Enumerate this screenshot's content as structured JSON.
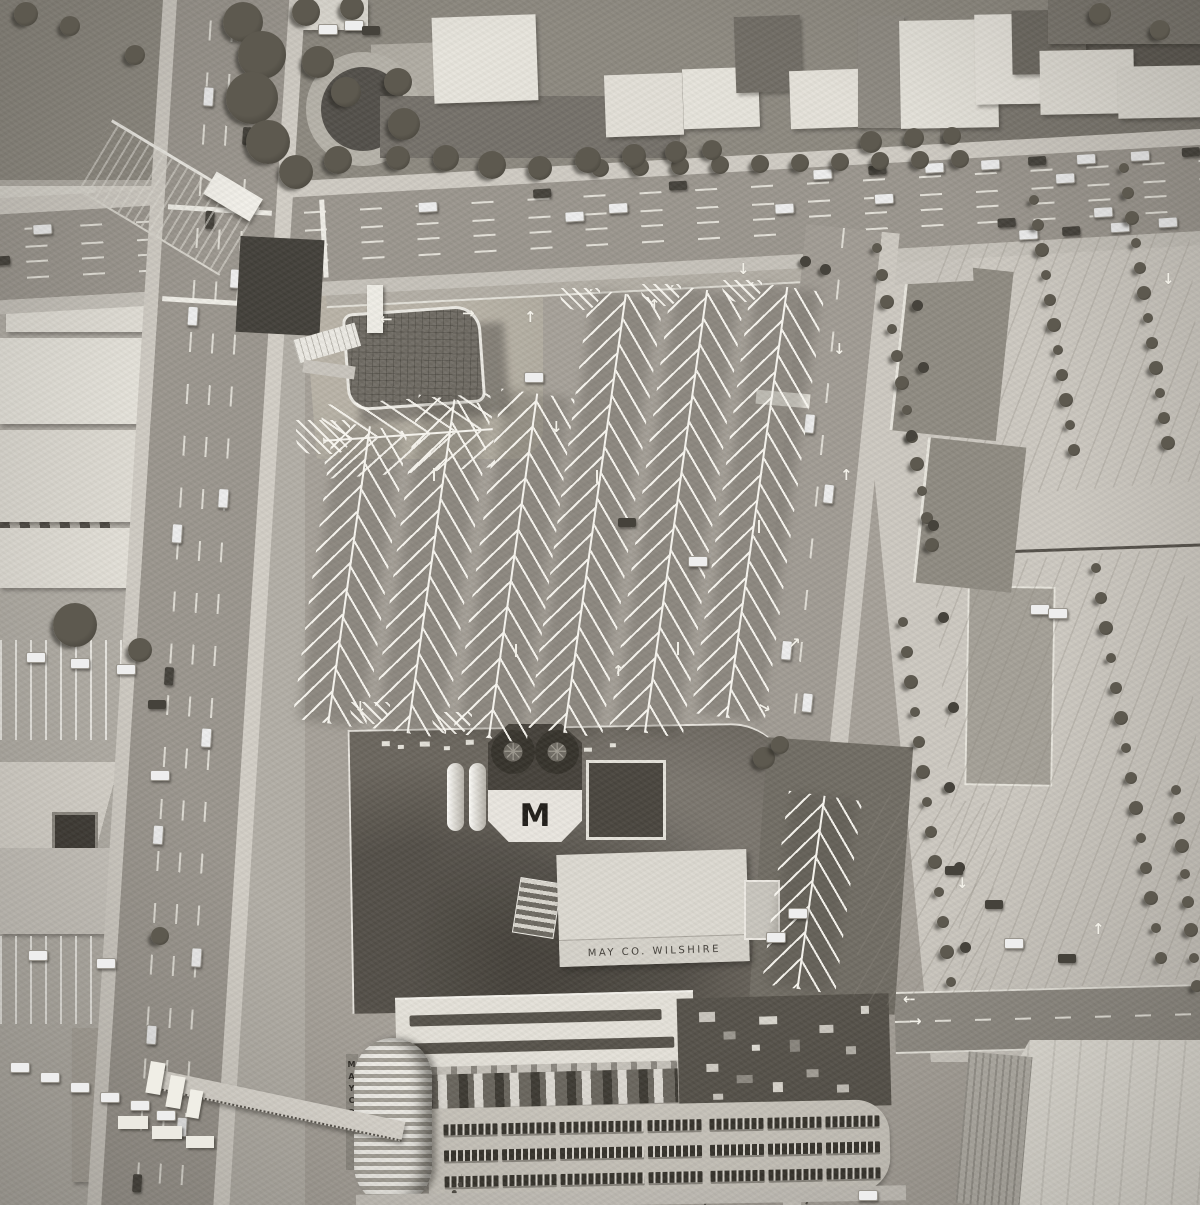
{
  "photo": {
    "medium": "black-and-white aerial photograph",
    "scene": "overhead view of a department store, parking lots and boulevard intersection"
  },
  "store": {
    "roof_sign": "MAY CO. WILSHIRE",
    "penthouse_monogram": "M",
    "tower_sign_vertical": "MAYCO"
  },
  "pavement_markings": {
    "arrow_up": "↑",
    "arrow_down": "↓",
    "arrow_left": "←",
    "arrow_right": "→",
    "arrow_up_right": "↗"
  },
  "icons": {
    "fan_blades": "✳"
  },
  "palette": {
    "lot": "#a6a199",
    "lot_light": "#cdc9c1",
    "asphalt": "#9b968e",
    "ground": "#8d8980",
    "roof_white": "#e7e4dc",
    "roof_dark": "#6b665e",
    "foliage": "#4c483f",
    "stripe": "#f2f0e8",
    "ink": "#2e2b26"
  }
}
